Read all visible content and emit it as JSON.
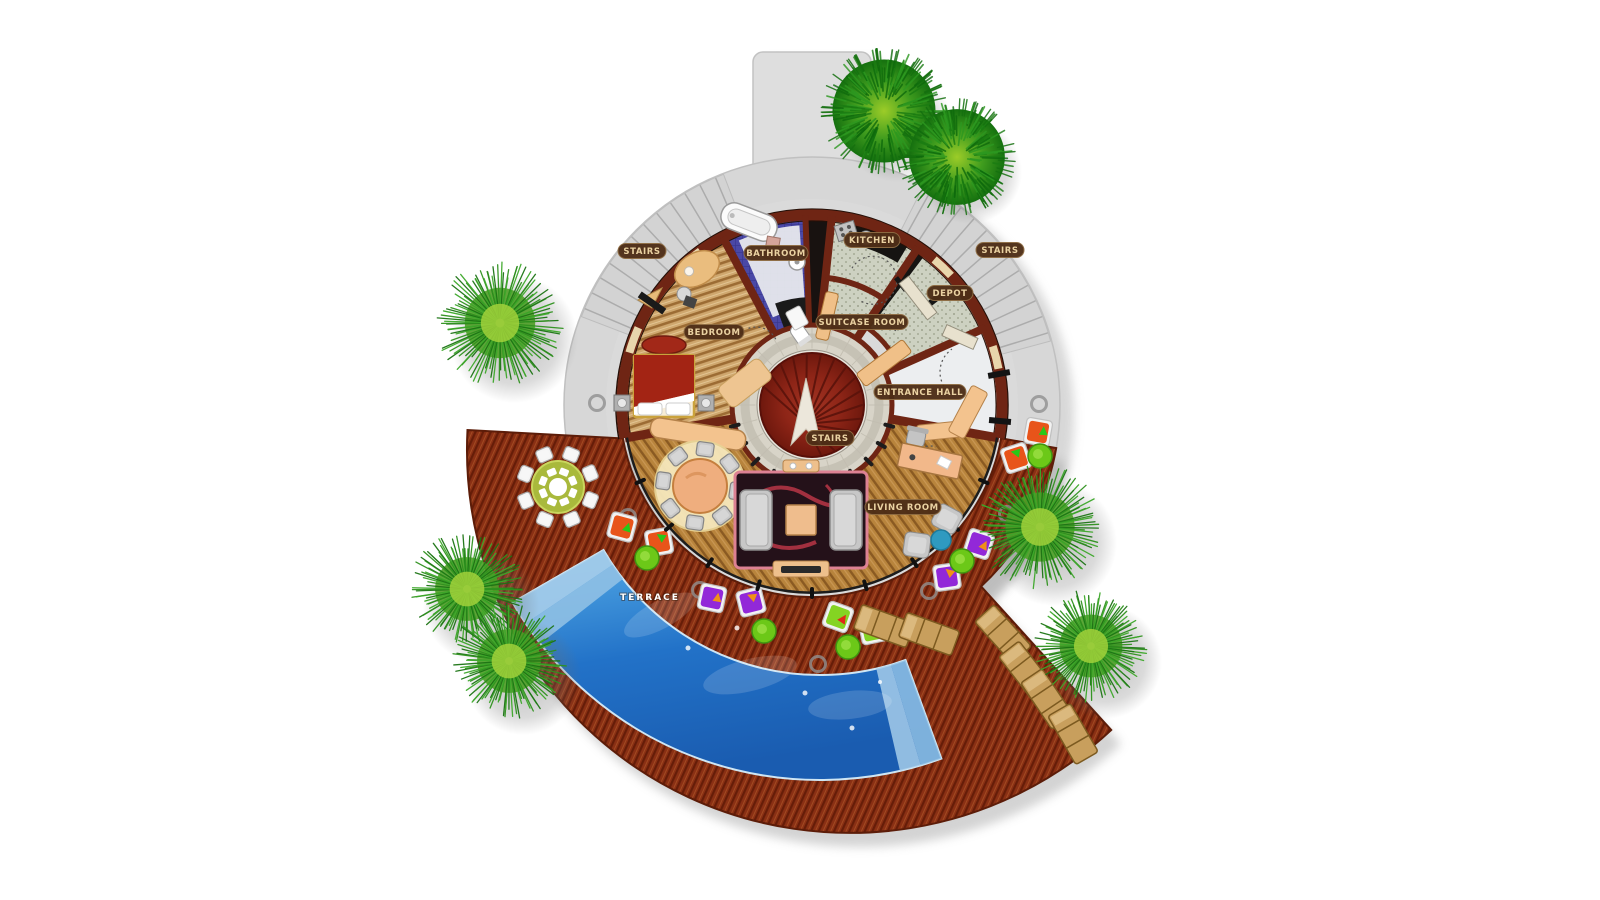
{
  "plan": {
    "rooms": {
      "bedroom": "BEDROOM",
      "bathroom": "BATHROOM",
      "kitchen": "KITCHEN",
      "depot": "DEPOT",
      "suitcase_room": "SUITCASE ROOM",
      "entrance_hall": "ENTRANCE HALL",
      "living_room": "LIVING ROOM",
      "terrace": "TERRACE"
    },
    "stairs": {
      "left": "STAIRS",
      "right": "STAIRS",
      "center": "STAIRS"
    }
  },
  "colors": {
    "site_pad": "#d7d7d7",
    "walkway": "#dedede",
    "wall": "#6f2514",
    "wood_living": "#b8843c",
    "wood_bedroom": "#cfa76e",
    "tile_utility": "#cdd1c1",
    "tile_bath": "#4a48a6",
    "marble_ring": "#d8d4c8",
    "stairs_red": "#8e2517",
    "deck": "#8a3014",
    "pool": "#2272c8",
    "pool_steps": "#9cc8e8",
    "badge_bg": "#4e2e17",
    "badge_text": "#ead2a2",
    "beanbag_orange": "#e8541a",
    "beanbag_purple": "#9228d8",
    "beanbag_lime": "#84d422",
    "beanbag_tri_green": "#28c818",
    "beanbag_tri_orange": "#f09018",
    "beanbag_tri_red": "#e02818",
    "ottoman_green": "#6cc818",
    "lounger_tan": "#c89f5d",
    "rug_dark": "#241119",
    "rug_accent": "#c23848",
    "sofa_gray": "#c7c7c7",
    "table_peach": "#efae7e",
    "outdoor_table_olive": "#a9b93c",
    "tree_palm": "#2f921e",
    "tree_pine": "#1a7c12"
  }
}
